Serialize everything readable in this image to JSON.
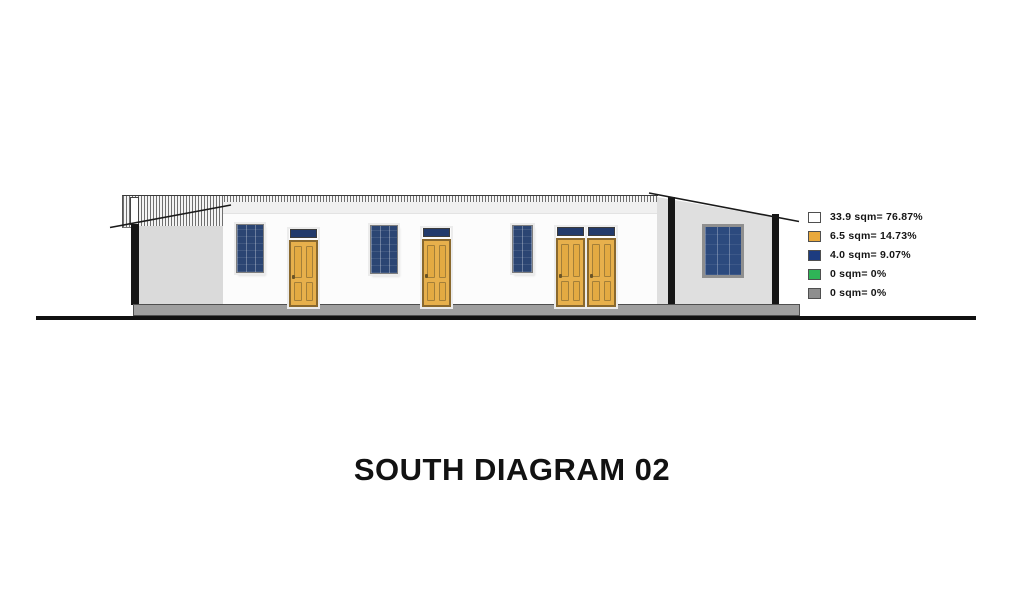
{
  "title": "SOUTH DIAGRAM 02",
  "legend": {
    "items": [
      {
        "name": "walls",
        "label": "33.9 sqm= 76.87%",
        "color": "#ffffff"
      },
      {
        "name": "doors",
        "label": "6.5 sqm= 14.73%",
        "color": "#e9a93c"
      },
      {
        "name": "windows",
        "label": "4.0 sqm= 9.07%",
        "color": "#1d3c80"
      },
      {
        "name": "green",
        "label": "0 sqm= 0%",
        "color": "#2fb457"
      },
      {
        "name": "gray",
        "label": "0 sqm= 0%",
        "color": "#8e8e8e"
      }
    ]
  },
  "palette": {
    "door_fill": "#e7b04c",
    "door_border": "#8a692e",
    "window_glass": "#2b4573",
    "transom": "#223a6b",
    "wall_gray": "#dadada",
    "plinth_gray": "#9f9f9f",
    "post_black": "#161616"
  }
}
